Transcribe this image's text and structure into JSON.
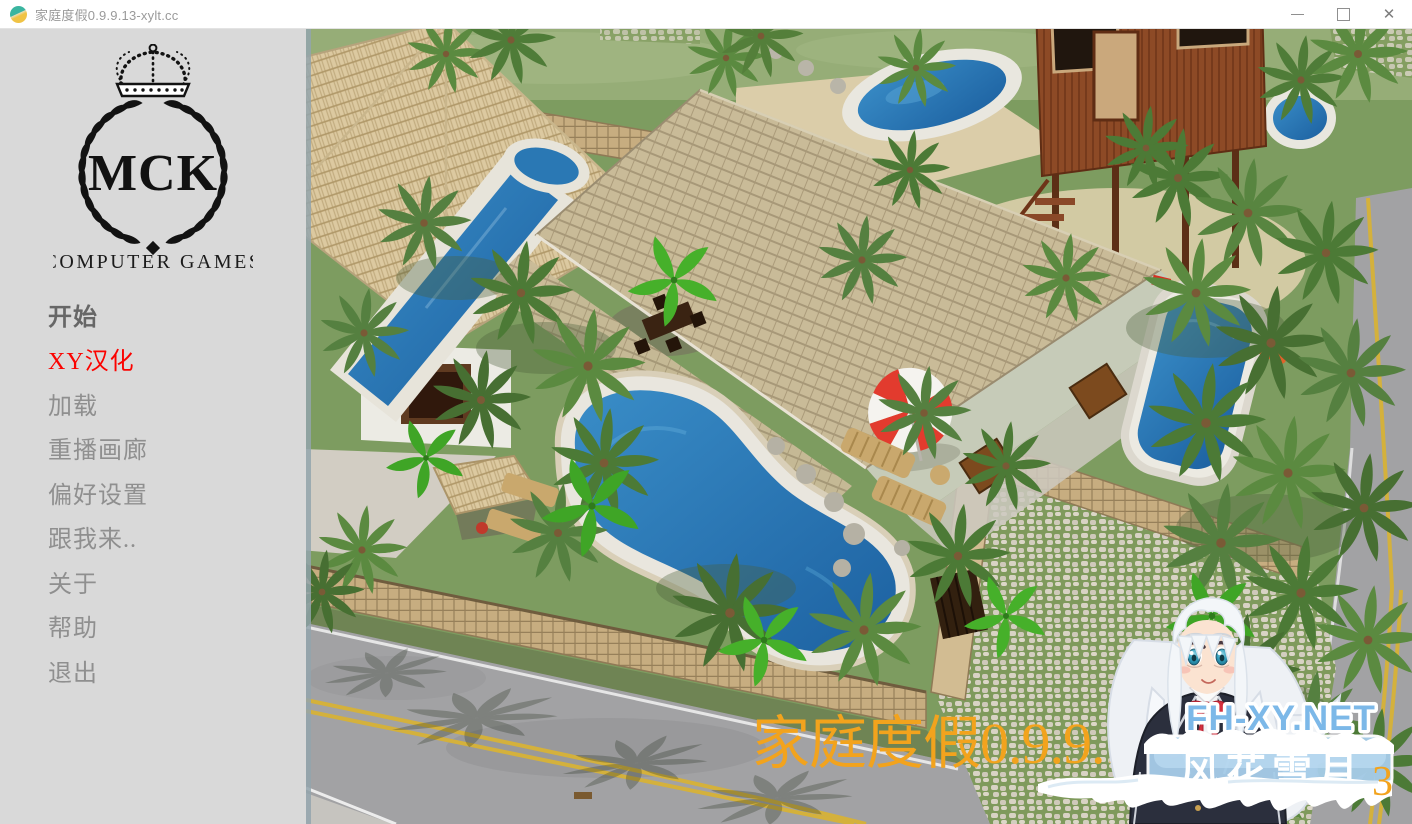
{
  "window": {
    "title": "家庭度假0.9.9.13-xylt.cc",
    "controls": {
      "close_glyph": "✕"
    }
  },
  "sidebar": {
    "logo": {
      "monogram": "MCK",
      "subtitle": "COMPUTER GAMES"
    },
    "menu": [
      {
        "label": "开始",
        "color": "#676767",
        "emphasis": true
      },
      {
        "label": "XY汉化",
        "color": "#fb0300",
        "emphasis": false
      },
      {
        "label": "加载",
        "color": "#8f8f8f",
        "emphasis": false
      },
      {
        "label": "重播画廊",
        "color": "#8f8f8f",
        "emphasis": false
      },
      {
        "label": "偏好设置",
        "color": "#8f8f8f",
        "emphasis": false
      },
      {
        "label": "跟我来..",
        "color": "#8f8f8f",
        "emphasis": false
      },
      {
        "label": "关于",
        "color": "#8f8f8f",
        "emphasis": false
      },
      {
        "label": "帮助",
        "color": "#8f8f8f",
        "emphasis": false
      },
      {
        "label": "退出",
        "color": "#8f8f8f",
        "emphasis": false
      }
    ]
  },
  "scene": {
    "palette": {
      "grass": "#7d9c60",
      "grass_light": "#96ad77",
      "pool_water": "#2477b4",
      "roof_shingle": "#c9bb98",
      "roof_thatch": "#dcc9a0",
      "stone_wall": "#c7ad80",
      "road": "#a2a2a4",
      "road_line_yellow": "#d4b13c",
      "treehouse_wood": "#8d4a26",
      "umbrella_red": "#e23b2e",
      "lounger_wood": "#c9a86d",
      "cobble_joint_green": "#7f9a5c"
    }
  },
  "watermark": {
    "game_title_overlay": "家庭度假0.9.9.13-xylt.cc",
    "overlay_color": "#f2a31d",
    "fragment_text": "3",
    "site_name": "FH-XY.NET",
    "site_color": "#7cb8e8",
    "banner_text": "风花雪月",
    "banner_bg": "#a6cce8"
  }
}
